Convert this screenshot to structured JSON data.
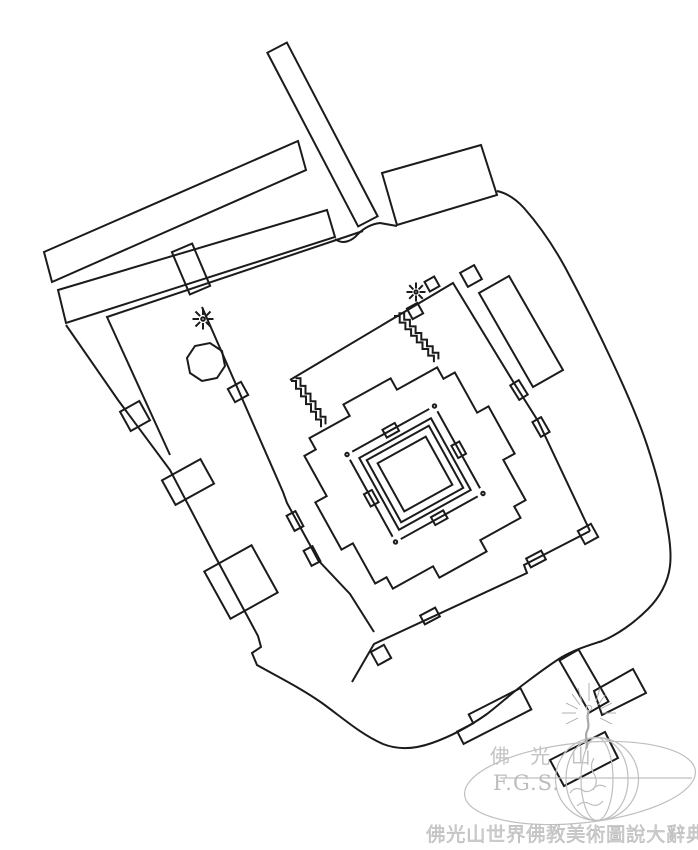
{
  "page": {
    "background_color": "#ffffff",
    "ink_color": "#1b1b1b",
    "watermark_color": "#bdbdbd",
    "caption_color": "#cfcfcf"
  },
  "caption": {
    "text": "佛光山世界佛教美術圖說大辭典"
  },
  "watermark": {
    "org_cn": "佛 光 山",
    "org_en": "F.G.S."
  }
}
